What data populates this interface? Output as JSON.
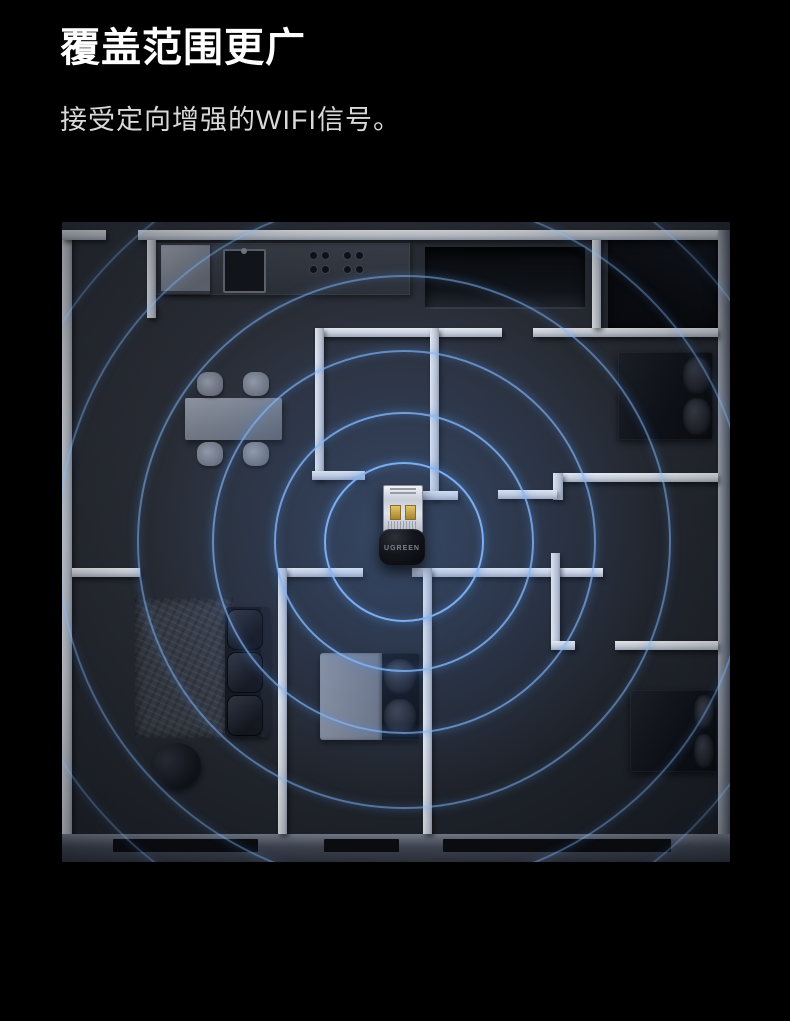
{
  "header": {
    "title": "覆盖范围更广",
    "subtitle": "接受定向增强的WIFI信号。"
  },
  "device": {
    "brand": "UGREEN",
    "type": "usb-wifi-adapter"
  },
  "floorplan": {
    "signal": {
      "center": {
        "x": 340,
        "y": 318
      },
      "ring_radii": [
        78,
        128,
        190,
        265,
        345,
        405
      ],
      "ring_color": "#5b9bd5"
    },
    "colors": {
      "page_background": "#000000",
      "floor": "#282c34",
      "wall_light": "#eef1f6",
      "wall_dark": "#565c6a",
      "signal_blue": "#82b4f5",
      "glow": "#3f74c9"
    }
  }
}
